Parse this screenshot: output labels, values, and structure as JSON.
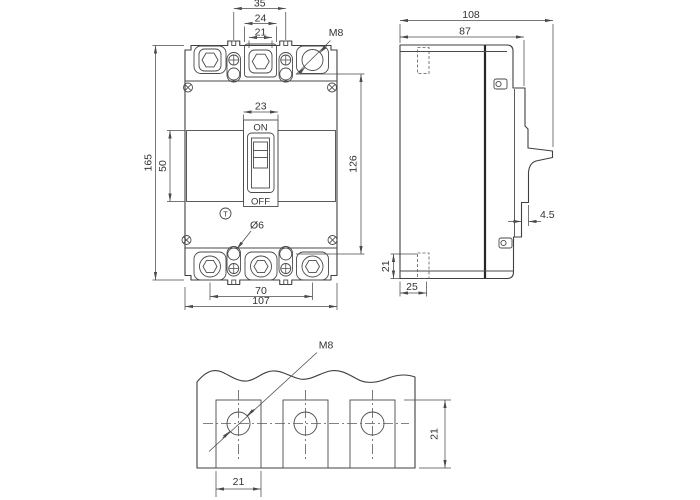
{
  "drawing_type": "circuit-breaker dimension drawing",
  "front": {
    "d35": "35",
    "d24": "24",
    "d21": "21",
    "m8": "M8",
    "d23": "23",
    "on": "ON",
    "off": "OFF",
    "d50": "50",
    "d165": "165",
    "d126": "126",
    "trip": "T",
    "dia6": "Ø6",
    "d70": "70",
    "d107": "107"
  },
  "side": {
    "d108": "108",
    "d87": "87",
    "d45": "4.5",
    "d21": "21",
    "d25": "25"
  },
  "bottom": {
    "m8": "M8",
    "d21w": "21",
    "d21h": "21"
  },
  "colors": {
    "line": "#3f3f3f",
    "text": "#333333",
    "seam": "#262626",
    "background": "#ffffff"
  }
}
